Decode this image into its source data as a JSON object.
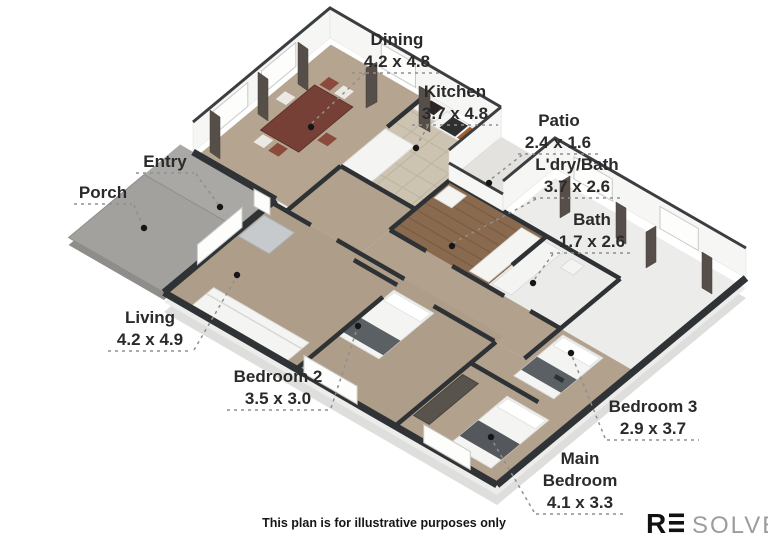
{
  "floorplan": {
    "labels": {
      "dining": {
        "name": "Dining",
        "dims": "4.2 x 4.8"
      },
      "kitchen": {
        "name": "Kitchen",
        "dims": "3.7 x 4.8"
      },
      "patio": {
        "name": "Patio",
        "dims": "2.4 x 1.6"
      },
      "ldry_bath": {
        "name": "L'dry/Bath",
        "dims": "3.7 x 2.6"
      },
      "bath": {
        "name": "Bath",
        "dims": "1.7 x 2.6"
      },
      "entry": {
        "name": "Entry"
      },
      "porch": {
        "name": "Porch"
      },
      "living": {
        "name": "Living",
        "dims": "4.2 x 4.9"
      },
      "bedroom2": {
        "name": "Bedroom 2",
        "dims": "3.5 x 3.0"
      },
      "bedroom3": {
        "name": "Bedroom 3",
        "dims": "2.9 x 3.7"
      },
      "main_bedroom": {
        "line1": "Main",
        "line2": "Bedroom",
        "dims": "4.1 x 3.3"
      }
    },
    "disclaimer": "This plan is for illustrative purposes only",
    "logo": {
      "r": "R",
      "rest": "SOLVE"
    },
    "colors": {
      "carpet": "#b2a18d",
      "tile": "#cdc3b1",
      "wood_floor": "#8a6a4e",
      "concrete": "#a3a19e",
      "wall_top": "#2f3336",
      "label_text": "#2a2a2a"
    }
  }
}
